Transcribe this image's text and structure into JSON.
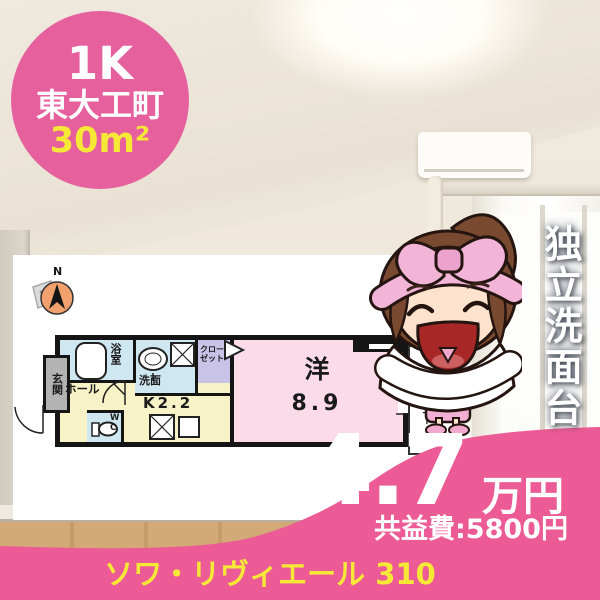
{
  "badge": {
    "layout_type": "1K",
    "location": "東大工町",
    "area": "30m²"
  },
  "feature_vertical": "独立洗面台",
  "price": {
    "amount": "4.7",
    "unit": "万円",
    "common_fee": "共益費:5800円"
  },
  "footer": {
    "building": "ソワ・リヴィエール 310"
  },
  "floorplan": {
    "compass_n": "N",
    "entrance": "玄関",
    "bathroom": "浴室",
    "washroom": "洗面",
    "closet": "クローゼット",
    "hall": "ホール",
    "kitchen": "K2.2",
    "toilet": "WC",
    "room": "洋",
    "room_size": "8.9",
    "balcony": "バルコニー"
  },
  "colors": {
    "accent-pink": "#ec5b95",
    "badge-pink": "#e7609e",
    "accent-yellow": "#f6e837",
    "room-yellow": "#f7f3c6",
    "room-blue": "#cfe7f1",
    "room-lavender": "#c9c3e8",
    "room-pink": "#fadbe7",
    "room-gray": "#b3b3b3",
    "compass-orange": "#f2a06e"
  }
}
